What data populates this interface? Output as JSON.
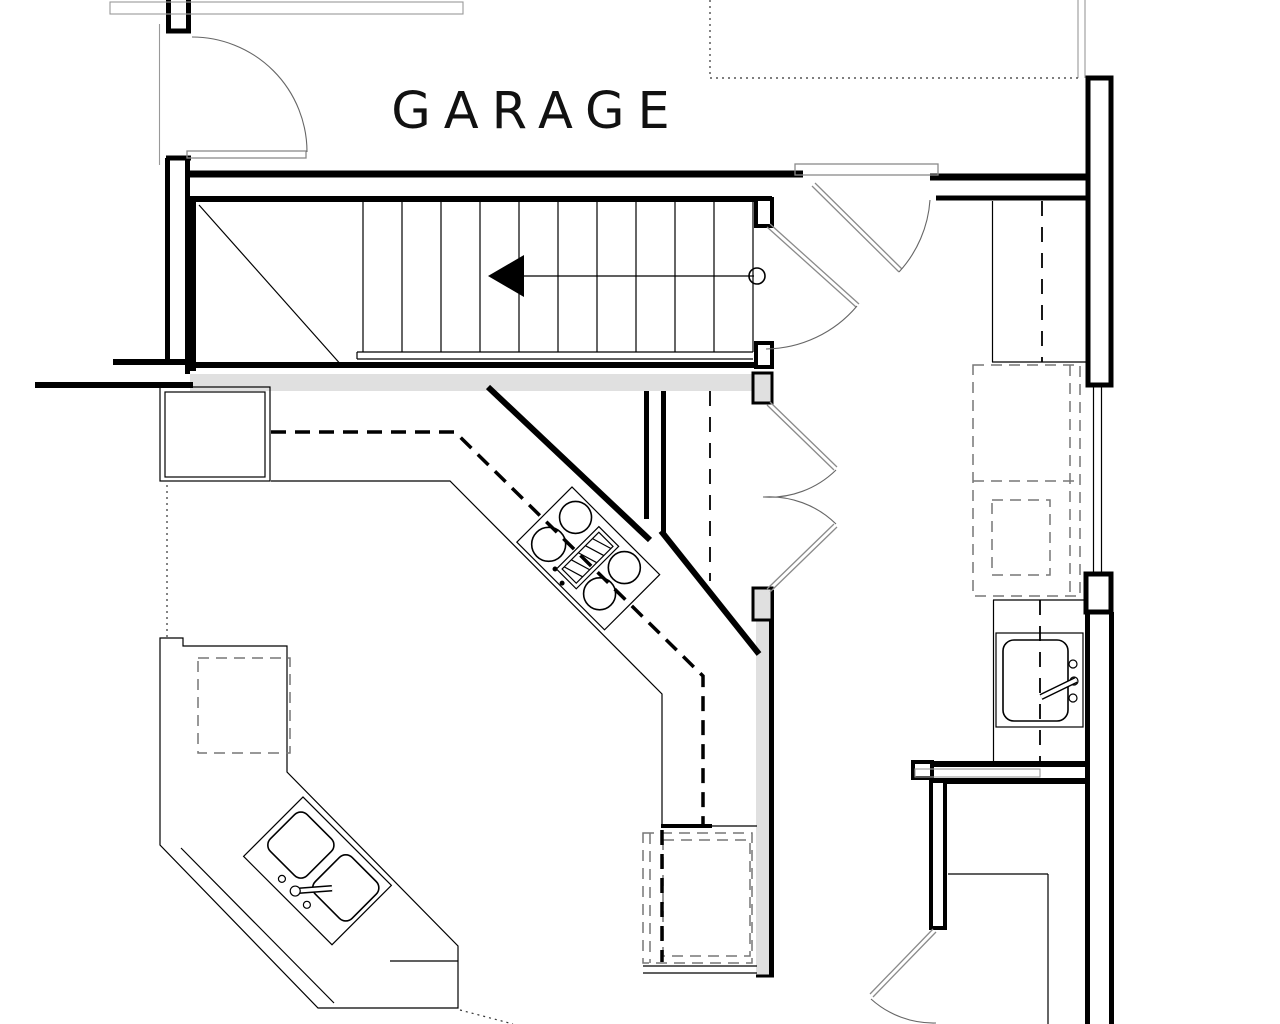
{
  "plan": {
    "room_label": "GARAGE",
    "colors": {
      "wall": "#000000",
      "background": "#ffffff",
      "floor_fill": "#e0e0e0",
      "door_line": "#8a8a8a",
      "arc_line": "#666666",
      "dashed_appliance": "#777777",
      "dotted_reference": "#333333",
      "thin_gray": "#999999"
    }
  }
}
